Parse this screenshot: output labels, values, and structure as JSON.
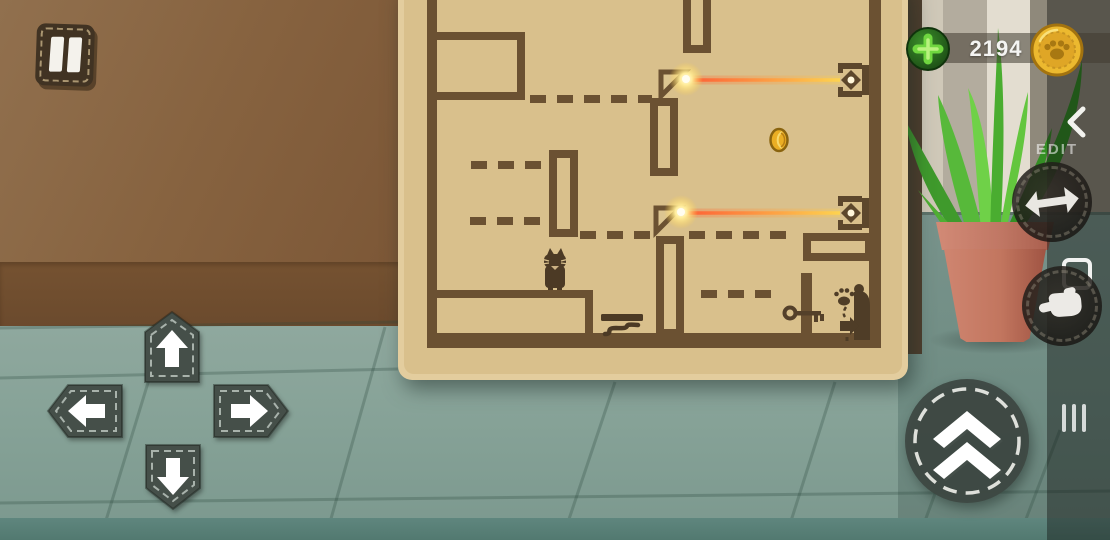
{
  "hud": {
    "pause_button": {
      "icon": "pause-icon"
    },
    "currency": {
      "plus_icon": "plus-icon",
      "amount": "2194",
      "coin_icon": "paw-coin-icon"
    },
    "edit_panel": {
      "collapse_icon": "chevron-left-icon",
      "label": "EDIT",
      "tools": [
        {
          "icon": "move-arrows-icon"
        },
        {
          "icon": "selection-frame-icon"
        },
        {
          "icon": "hand-drag-icon"
        }
      ],
      "drawer_handle_icon": "drawer-handle-icon"
    }
  },
  "controls": {
    "dpad": [
      {
        "dir": "up",
        "icon": "arrow-up-icon"
      },
      {
        "dir": "left",
        "icon": "arrow-left-icon"
      },
      {
        "dir": "right",
        "icon": "arrow-right-icon"
      },
      {
        "dir": "down",
        "icon": "arrow-down-icon"
      }
    ],
    "jump": {
      "icon": "double-chevron-up-icon"
    }
  },
  "scene": {
    "plant": "aloe-plant",
    "pot": "terracotta-pot"
  },
  "board": {
    "colors": {
      "cardboard": "#d9c08c",
      "edge": "#e3cd9e",
      "wall": "#6b5132",
      "laser_near": "#ff5c34",
      "laser_far": "#ffd44e"
    },
    "walls": [
      {
        "x": 427,
        "y": 0,
        "w": 10,
        "h": 348
      },
      {
        "x": 869,
        "y": 0,
        "w": 12,
        "h": 348
      },
      {
        "x": 427,
        "y": 333,
        "w": 454,
        "h": 15
      },
      {
        "x": 801,
        "y": 273,
        "w": 11,
        "h": 64
      }
    ],
    "outlined_rects": [
      {
        "x": 427,
        "y": 32,
        "w": 98,
        "h": 68
      },
      {
        "x": 683,
        "y": -10,
        "w": 28,
        "h": 63
      },
      {
        "x": 650,
        "y": 98,
        "w": 28,
        "h": 78
      },
      {
        "x": 549,
        "y": 150,
        "w": 29,
        "h": 87
      },
      {
        "x": 656,
        "y": 236,
        "w": 28,
        "h": 101
      },
      {
        "x": 803,
        "y": 233,
        "w": 70,
        "h": 28
      },
      {
        "x": 428,
        "y": 290,
        "w": 165,
        "h": 52
      }
    ],
    "dashed_lines": [
      {
        "x1": 530,
        "x2": 652,
        "y": 99
      },
      {
        "x1": 471,
        "x2": 545,
        "y": 165
      },
      {
        "x1": 470,
        "x2": 542,
        "y": 221
      },
      {
        "x1": 580,
        "x2": 653,
        "y": 235
      },
      {
        "x1": 689,
        "x2": 790,
        "y": 235
      },
      {
        "x1": 701,
        "x2": 779,
        "y": 294
      }
    ],
    "mirrors": [
      {
        "x": 659,
        "y": 70
      },
      {
        "x": 654,
        "y": 206
      }
    ],
    "receivers": [
      {
        "x": 838,
        "y": 63
      },
      {
        "x": 838,
        "y": 196
      }
    ],
    "lasers": [
      {
        "x1": 688,
        "y": 80,
        "x2": 840
      },
      {
        "x1": 683,
        "y": 213,
        "x2": 840
      }
    ],
    "glows": [
      {
        "x": 686,
        "y": 79
      },
      {
        "x": 681,
        "y": 212
      }
    ],
    "sprites": [
      {
        "symbol": "cat",
        "x": 542,
        "y": 246
      },
      {
        "symbol": "coin",
        "x": 770,
        "y": 128
      },
      {
        "symbol": "spring",
        "x": 601,
        "y": 314
      },
      {
        "symbol": "key",
        "x": 783,
        "y": 302
      },
      {
        "symbol": "exit",
        "x": 832,
        "y": 280
      }
    ]
  }
}
